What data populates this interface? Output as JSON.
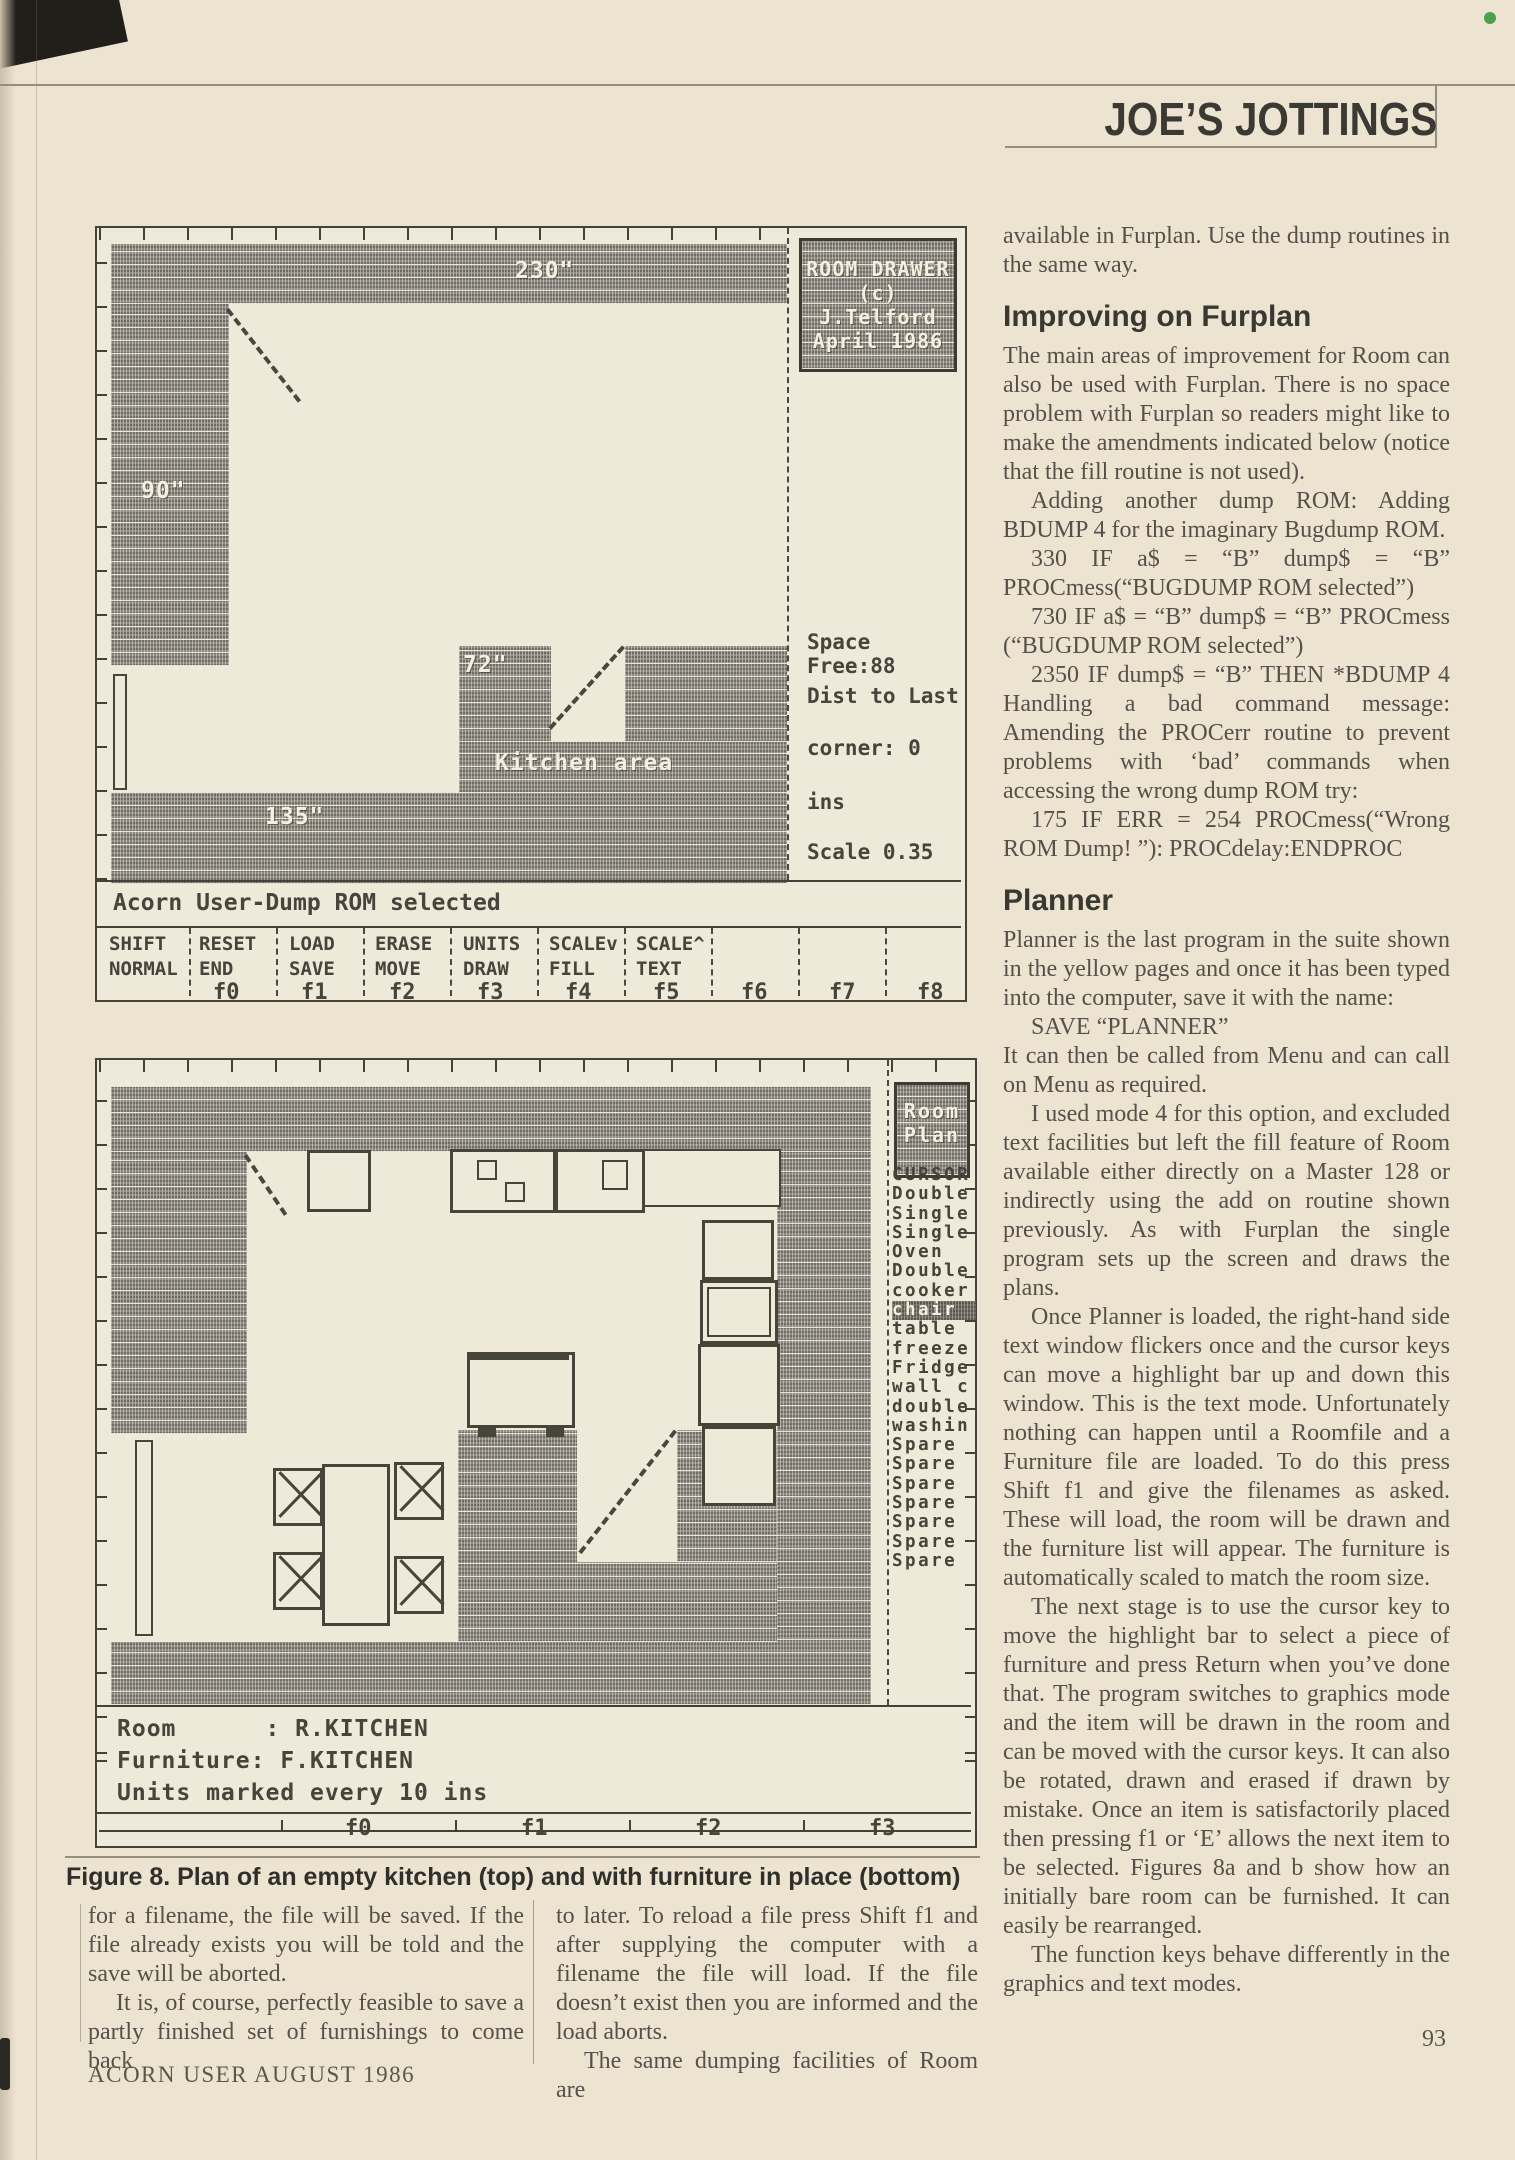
{
  "page": {
    "masthead": "JOE’S JOTTINGS",
    "caption": "Figure 8. Plan of an empty kitchen (top) and with furniture in place (bottom)",
    "footer": "ACORN USER AUGUST 1986",
    "page_number": "93"
  },
  "screen1": {
    "title_lines": [
      "ROOM DRAWER",
      "(c) J.Telford",
      "April 1986"
    ],
    "dim_top": "230\"",
    "dim_left": "90\"",
    "dim_island": "72\"",
    "dim_bottom": "135\"",
    "area_label": "Kitchen area",
    "info_lines": [
      "Space Free:88",
      "Dist to Last",
      "corner: 0",
      "ins",
      "Scale 0.35"
    ],
    "status": "Acorn User-Dump ROM selected",
    "fkeys": [
      [
        "SHIFT",
        "NORMAL"
      ],
      [
        "RESET",
        "END"
      ],
      [
        "LOAD",
        "SAVE"
      ],
      [
        "ERASE",
        "MOVE"
      ],
      [
        "UNITS",
        "DRAW"
      ],
      [
        "SCALEv",
        "FILL"
      ],
      [
        "SCALE^",
        "TEXT"
      ]
    ],
    "fkey_nums": [
      "f0",
      "f1",
      "f2",
      "f3",
      "f4",
      "f5",
      "f6",
      "f7",
      "f8"
    ]
  },
  "screen2": {
    "title_lines": [
      "Room",
      "Plan"
    ],
    "menu": [
      "CURSOR",
      "Double",
      "Single",
      "Single",
      "Oven",
      "Double",
      "cooker",
      "chair",
      "table",
      "freeze",
      "Fridge",
      "wall c",
      "double",
      "washin",
      "Spare",
      "Spare",
      "Spare",
      "Spare",
      "Spare",
      "Spare",
      "Spare"
    ],
    "highlighted_item": "chair",
    "status_lines": [
      "Room      : R.KITCHEN",
      "Furniture: F.KITCHEN",
      "Units marked every 10 ins"
    ],
    "fkey_nums": [
      "f0",
      "f1",
      "f2",
      "f3"
    ]
  },
  "article": {
    "left_col": [
      {
        "text": "for a filename, the file will be saved. If the file already exists you will be told and the save will be aborted."
      },
      {
        "text": "It is, of course, perfectly feasible to save a partly finished set of furnishings to come back"
      }
    ],
    "mid_col": [
      {
        "text": "to later. To reload a file press Shift f1 and after supplying the computer with a filename the file will load. If the file doesn’t exist then you are informed and the load aborts."
      },
      {
        "text": "The same dumping facilities of Room are"
      }
    ],
    "right_col": [
      {
        "type": "p",
        "text": "available in Furplan. Use the dump routines in the same way."
      },
      {
        "type": "h",
        "text": "Improving on Furplan"
      },
      {
        "type": "p",
        "text": "The main areas of improvement for Room can also be used with Furplan. There is no space problem with Furplan so readers might like to make the amendments indicated below (notice that the fill routine is not used)."
      },
      {
        "type": "pi",
        "text": "Adding another dump ROM: Adding BDUMP 4 for the imaginary Bugdump ROM."
      },
      {
        "type": "pi",
        "text": "330 IF a$ = “B” dump$ = “B” PROCmess(“BUGDUMP ROM selected”)"
      },
      {
        "type": "pi",
        "text": "730 IF a$ = “B” dump$ = “B” PROCmess (“BUGDUMP ROM selected”)"
      },
      {
        "type": "pi",
        "text": "2350 IF dump$ = “B” THEN *BDUMP 4 Handling a bad command message: Amending the PROCerr routine to prevent problems with ‘bad’ commands when accessing the wrong dump ROM try:"
      },
      {
        "type": "pi",
        "text": "175 IF ERR = 254 PROCmess(“Wrong ROM Dump! ”): PROCdelay:ENDPROC"
      },
      {
        "type": "h",
        "text": "Planner"
      },
      {
        "type": "p",
        "text": "Planner is the last program in the suite shown in the yellow pages and once it has been typed into the computer, save it with the name:"
      },
      {
        "type": "pi",
        "text": "SAVE “PLANNER”"
      },
      {
        "type": "p",
        "text": "It can then be called from Menu and can call on Menu as required."
      },
      {
        "type": "pi",
        "text": "I used mode 4 for this option, and excluded text facilities but left the fill feature of Room available either directly on a Master 128 or indirectly using the add on routine shown previously. As with Furplan the single program sets up the screen and draws the plans."
      },
      {
        "type": "pi",
        "text": "Once Planner is loaded, the right-hand side text window flickers once and the cursor keys can move a highlight bar up and down this window. This is the text mode. Unfortunately nothing can happen until a Roomfile and a Furniture file are loaded. To do this press Shift f1 and give the filenames as asked. These will load, the room will be drawn and the furniture list will appear. The furniture is automatically scaled to match the room size."
      },
      {
        "type": "pi",
        "text": "The next stage is to use the cursor key to move the highlight bar to select a piece of furniture and press Return when you’ve done that. The program switches to graphics mode and the item will be drawn in the room and can be moved with the cursor keys. It can also be rotated, drawn and erased if drawn by mistake. Once an item is satisfactorily placed then pressing f1 or ‘E’ allows the next item to be selected. Figures 8a and b show how an initially bare room can be furnished. It can easily be rearranged."
      },
      {
        "type": "pi",
        "text": "The function keys behave differently in the graphics and text modes."
      }
    ]
  }
}
